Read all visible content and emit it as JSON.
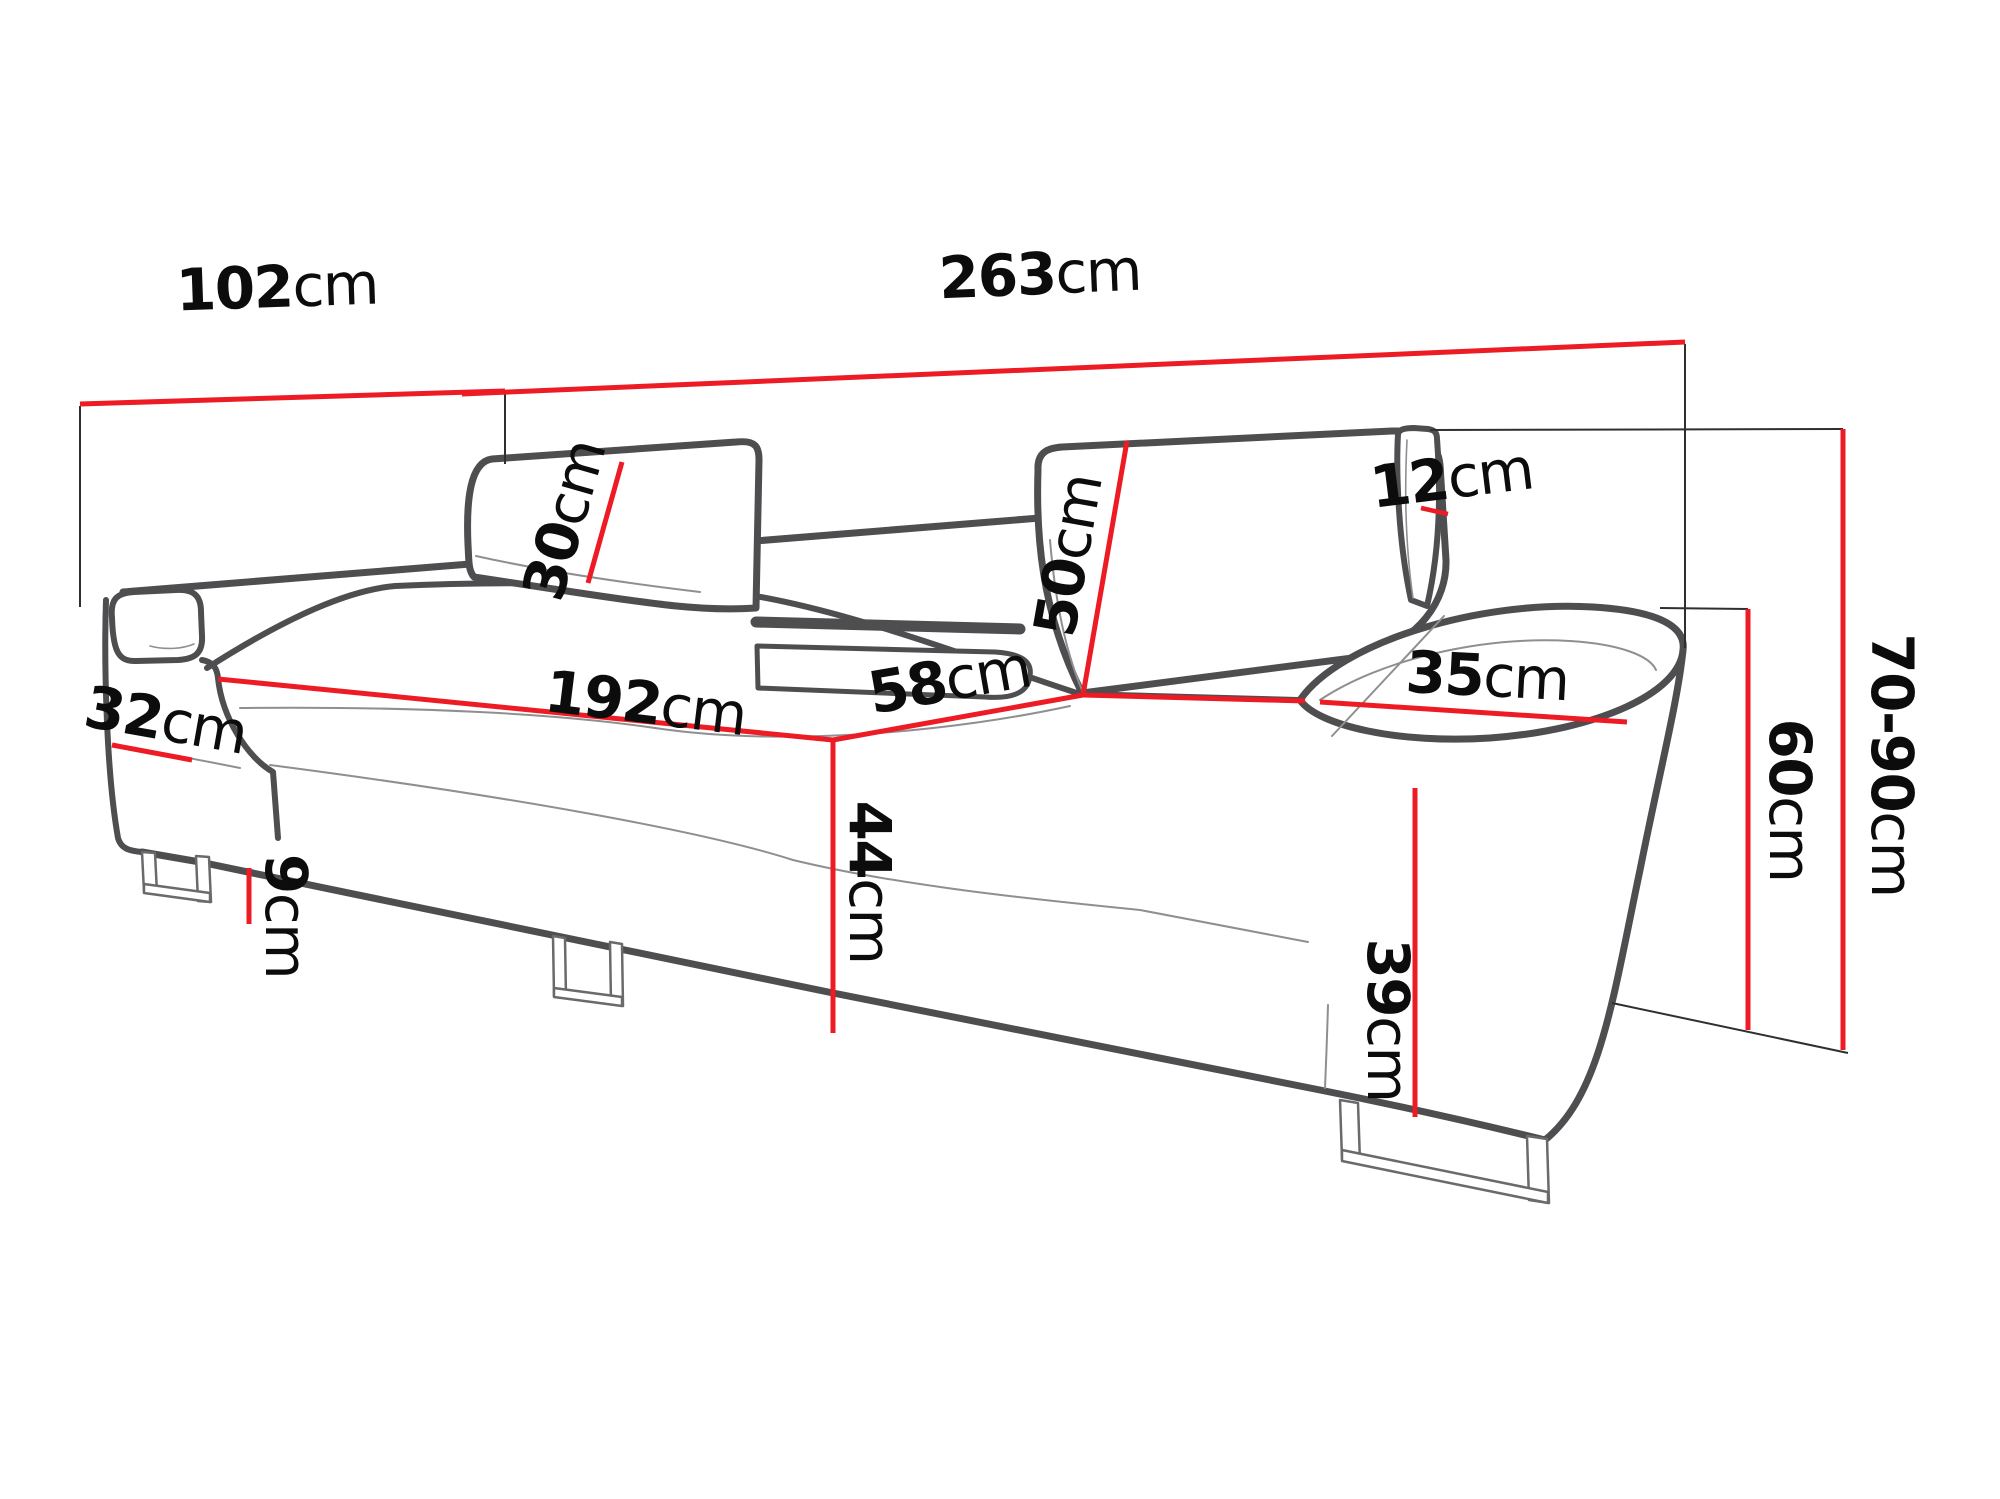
{
  "colors": {
    "background": "#ffffff",
    "dimension_red": "#ed1b24",
    "outline_dark": "#4e4e50",
    "outline_thin": "#8f8f91",
    "helper_black": "#2f2f2f",
    "label_black": "#0c0c0c"
  },
  "diagram": {
    "unit": "cm",
    "measurements": {
      "depth_total": {
        "value": "102",
        "unit": "cm"
      },
      "width_total": {
        "value": "263",
        "unit": "cm"
      },
      "headrest_height": {
        "value": "30",
        "unit": "cm"
      },
      "backrest_height": {
        "value": "50",
        "unit": "cm"
      },
      "headrest_thickness": {
        "value": "12",
        "unit": "cm"
      },
      "seat_width": {
        "value": "192",
        "unit": "cm"
      },
      "seat_depth": {
        "value": "58",
        "unit": "cm"
      },
      "armrest_length": {
        "value": "35",
        "unit": "cm"
      },
      "seat_height": {
        "value": "44",
        "unit": "cm"
      },
      "armrest_width": {
        "value": "32",
        "unit": "cm"
      },
      "floor_clearance": {
        "value": "9",
        "unit": "cm"
      },
      "armrest_front_height": {
        "value": "39",
        "unit": "cm"
      },
      "armrest_total_height": {
        "value": "60",
        "unit": "cm"
      },
      "adjustable_total_height": {
        "value": "70-90",
        "unit": "cm"
      }
    }
  }
}
